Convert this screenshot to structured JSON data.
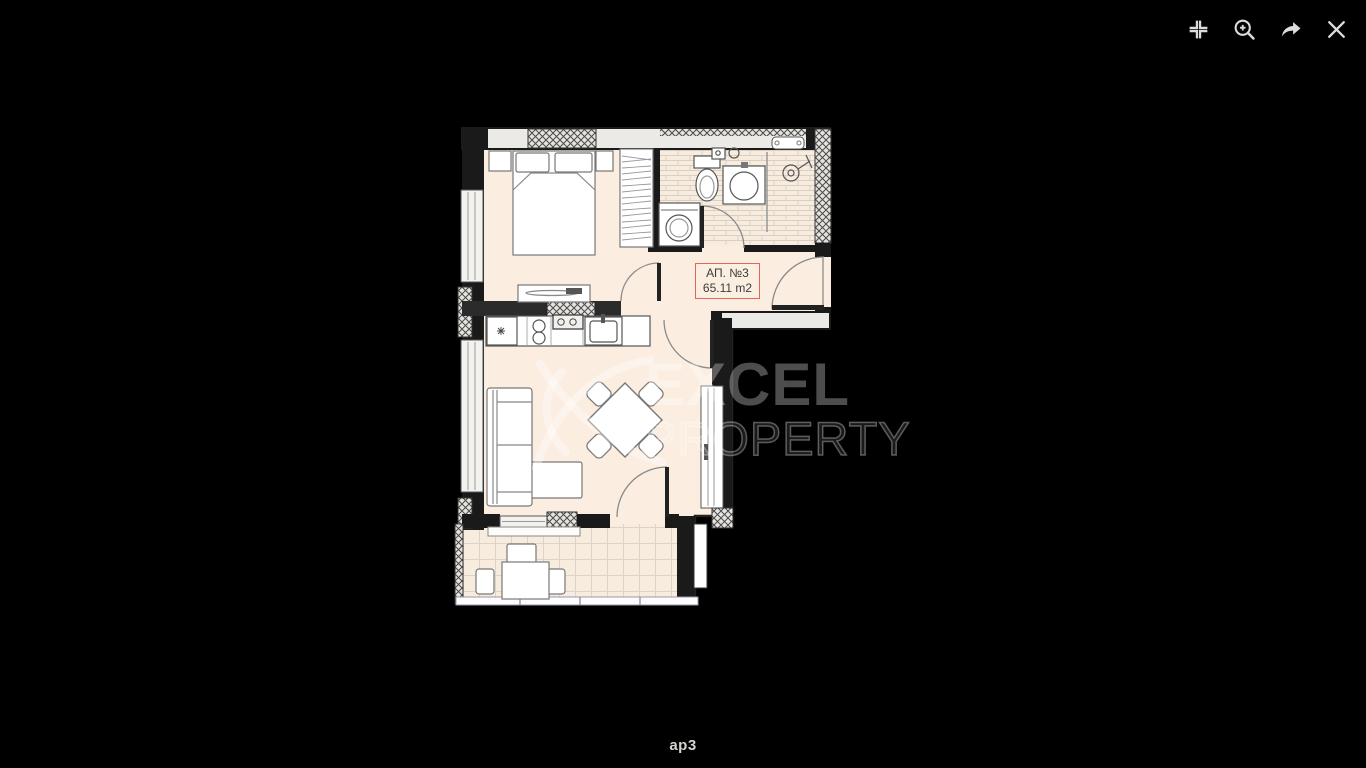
{
  "viewer": {
    "background_color": "#000000",
    "caption": "ap3"
  },
  "toolbar": {
    "icons": [
      {
        "name": "collapse"
      },
      {
        "name": "zoom-in"
      },
      {
        "name": "share"
      },
      {
        "name": "close"
      }
    ]
  },
  "floorplan": {
    "unit_label": {
      "line1": "АП. №3",
      "line2": "65.11 m2"
    },
    "watermark": {
      "line1": "EXCEL",
      "line2": "PROPERTY"
    },
    "colors": {
      "floor": "#fbeee1",
      "wall": "#1a1a1a",
      "label_border": "#e4655a",
      "label_text": "#3d3d3d",
      "watermark": "rgba(255,255,255,0.3)"
    }
  }
}
